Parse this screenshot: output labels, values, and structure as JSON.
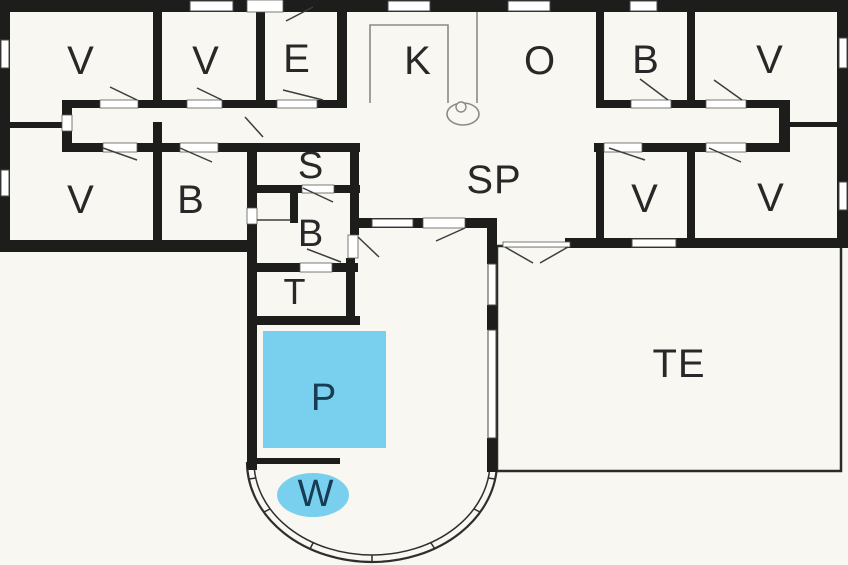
{
  "plan": {
    "title": "Holiday house floor plan",
    "colors": {
      "background": "#f8f7f1",
      "wall": "#1d1d1b",
      "line": "#3d3d3d",
      "fixture": "#8b8b85",
      "window_fill": "#ffffff",
      "window_stroke": "#4a4a48",
      "pool_fill": "#79d0ee",
      "pool_label": "#173c54",
      "label": "#282828",
      "terrace_stroke": "#2b2b2b"
    },
    "rooms": [
      {
        "id": "bedroom-1",
        "label": "V",
        "x": 81,
        "y": 61,
        "fs": 40
      },
      {
        "id": "bedroom-2",
        "label": "V",
        "x": 206,
        "y": 61,
        "fs": 40
      },
      {
        "id": "entrance",
        "label": "E",
        "x": 297,
        "y": 59,
        "fs": 40
      },
      {
        "id": "kitchen",
        "label": "K",
        "x": 418,
        "y": 61,
        "fs": 40
      },
      {
        "id": "dining",
        "label": "O",
        "x": 540,
        "y": 61,
        "fs": 40
      },
      {
        "id": "bathroom-1",
        "label": "B",
        "x": 646,
        "y": 60,
        "fs": 40
      },
      {
        "id": "bedroom-3",
        "label": "V",
        "x": 770,
        "y": 60,
        "fs": 40
      },
      {
        "id": "bedroom-4",
        "label": "V",
        "x": 81,
        "y": 200,
        "fs": 40
      },
      {
        "id": "bathroom-2",
        "label": "B",
        "x": 191,
        "y": 200,
        "fs": 40
      },
      {
        "id": "sauna",
        "label": "S",
        "x": 311,
        "y": 166,
        "fs": 38
      },
      {
        "id": "bathroom-3",
        "label": "B",
        "x": 311,
        "y": 234,
        "fs": 38
      },
      {
        "id": "toilet",
        "label": "T",
        "x": 295,
        "y": 292,
        "fs": 36
      },
      {
        "id": "living-room",
        "label": "SP",
        "x": 494,
        "y": 180,
        "fs": 40
      },
      {
        "id": "bedroom-5",
        "label": "V",
        "x": 645,
        "y": 199,
        "fs": 40
      },
      {
        "id": "bedroom-6",
        "label": "V",
        "x": 771,
        "y": 198,
        "fs": 40
      },
      {
        "id": "pool",
        "label": "P",
        "x": 324,
        "y": 398,
        "fs": 38,
        "accent": true
      },
      {
        "id": "whirlpool",
        "label": "W",
        "x": 316,
        "y": 494,
        "fs": 38,
        "accent": true
      },
      {
        "id": "terrace",
        "label": "TE",
        "x": 679,
        "y": 364,
        "fs": 40
      }
    ],
    "geometry": {
      "walls": [
        [
          0,
          0,
          848,
          12
        ],
        [
          0,
          0,
          10,
          250
        ],
        [
          837,
          0,
          11,
          248
        ],
        [
          0,
          240,
          255,
          12
        ],
        [
          565,
          238,
          283,
          10
        ],
        [
          153,
          0,
          9,
          100
        ],
        [
          256,
          0,
          9,
          100
        ],
        [
          337,
          0,
          10,
          100
        ],
        [
          596,
          0,
          8,
          100
        ],
        [
          687,
          0,
          8,
          100
        ],
        [
          62,
          100,
          38,
          8
        ],
        [
          138,
          100,
          49,
          8
        ],
        [
          222,
          100,
          55,
          8
        ],
        [
          317,
          100,
          30,
          8
        ],
        [
          62,
          143,
          41,
          9
        ],
        [
          137,
          143,
          43,
          9
        ],
        [
          218,
          143,
          34,
          9
        ],
        [
          62,
          100,
          10,
          52
        ],
        [
          10,
          122,
          53,
          6
        ],
        [
          153,
          122,
          9,
          118
        ],
        [
          247,
          143,
          10,
          327
        ],
        [
          250,
          143,
          110,
          9
        ],
        [
          250,
          185,
          52,
          8
        ],
        [
          334,
          185,
          26,
          8
        ],
        [
          290,
          193,
          8,
          30
        ],
        [
          250,
          263,
          50,
          9
        ],
        [
          332,
          263,
          26,
          9
        ],
        [
          250,
          316,
          110,
          9
        ],
        [
          350,
          143,
          9,
          92
        ],
        [
          346,
          258,
          9,
          67
        ],
        [
          357,
          218,
          66,
          10
        ],
        [
          465,
          218,
          32,
          10
        ],
        [
          487,
          218,
          10,
          46
        ],
        [
          487,
          305,
          10,
          25
        ],
        [
          487,
          438,
          10,
          34
        ],
        [
          596,
          100,
          35,
          8
        ],
        [
          671,
          100,
          35,
          8
        ],
        [
          746,
          100,
          44,
          8
        ],
        [
          594,
          143,
          10,
          9
        ],
        [
          642,
          143,
          64,
          9
        ],
        [
          746,
          143,
          44,
          9
        ],
        [
          779,
          100,
          11,
          52
        ],
        [
          790,
          122,
          47,
          5
        ],
        [
          596,
          143,
          8,
          97
        ],
        [
          687,
          143,
          8,
          97
        ],
        [
          253,
          458,
          87,
          6
        ]
      ],
      "windows": [
        [
          190,
          1,
          43,
          10
        ],
        [
          388,
          1,
          42,
          10
        ],
        [
          508,
          1,
          42,
          10
        ],
        [
          630,
          1,
          27,
          10
        ],
        [
          1,
          40,
          8,
          28
        ],
        [
          1,
          170,
          8,
          26
        ],
        [
          839,
          38,
          8,
          30
        ],
        [
          839,
          182,
          8,
          28
        ],
        [
          632,
          239,
          44,
          8
        ],
        [
          372,
          219,
          41,
          8
        ],
        [
          488,
          264,
          8,
          41
        ],
        [
          488,
          330,
          8,
          108
        ]
      ],
      "openings": [
        [
          100,
          100,
          38,
          8
        ],
        [
          187,
          100,
          35,
          8
        ],
        [
          277,
          100,
          40,
          8
        ],
        [
          103,
          143,
          34,
          9
        ],
        [
          180,
          143,
          38,
          9
        ],
        [
          62,
          115,
          10,
          16
        ],
        [
          631,
          100,
          40,
          8
        ],
        [
          706,
          100,
          40,
          8
        ],
        [
          604,
          143,
          38,
          9
        ],
        [
          706,
          143,
          40,
          9
        ],
        [
          423,
          218,
          42,
          10
        ],
        [
          348,
          235,
          10,
          23
        ],
        [
          302,
          185,
          32,
          8
        ],
        [
          300,
          263,
          32,
          9
        ],
        [
          247,
          208,
          10,
          16
        ],
        [
          503,
          242,
          67,
          5
        ],
        [
          247,
          0,
          36,
          12
        ]
      ],
      "swings": [
        [
          313,
          7,
          286,
          21
        ],
        [
          110,
          87,
          137,
          100
        ],
        [
          197,
          88,
          222,
          100
        ],
        [
          283,
          90,
          323,
          100
        ],
        [
          103,
          148,
          137,
          160
        ],
        [
          180,
          148,
          212,
          162
        ],
        [
          245,
          117,
          263,
          137
        ],
        [
          303,
          188,
          333,
          202
        ],
        [
          307,
          249,
          341,
          262
        ],
        [
          358,
          237,
          379,
          257
        ],
        [
          465,
          228,
          436,
          241
        ],
        [
          505,
          247,
          533,
          263
        ],
        [
          568,
          247,
          540,
          263
        ],
        [
          640,
          79,
          668,
          100
        ],
        [
          714,
          80,
          742,
          100
        ],
        [
          609,
          148,
          645,
          160
        ],
        [
          709,
          148,
          741,
          162
        ],
        [
          257,
          220,
          291,
          220
        ]
      ],
      "pool": {
        "x": 263,
        "y": 331,
        "w": 123,
        "h": 117
      },
      "whirlpool": {
        "cx": 313,
        "cy": 495,
        "rx": 36,
        "ry": 22
      },
      "terrace_rect": {
        "x": 497,
        "y": 246,
        "w": 344,
        "h": 225
      },
      "bay": {
        "outer": "M247,462 A125,100 0 0 0 497,462",
        "inner": "M254,462 A118,93 0 0 0 490,462",
        "ticks": [
          [
            249,
            479,
            256,
            478
          ],
          [
            264,
            512,
            270,
            509
          ],
          [
            310,
            549,
            313,
            543
          ],
          [
            372,
            562,
            372,
            555
          ],
          [
            435,
            549,
            431,
            543
          ],
          [
            480,
            512,
            474,
            509
          ],
          [
            495,
            479,
            488,
            478
          ]
        ]
      },
      "fixtures": {
        "counter": "M370,103 V25 H448 V103",
        "divider": [
          477,
          12,
          477,
          103
        ],
        "wc_ellipse": {
          "cx": 463,
          "cy": 114,
          "rx": 16,
          "ry": 11
        },
        "wc_circle": {
          "cx": 461,
          "cy": 107,
          "r": 5
        }
      }
    }
  }
}
